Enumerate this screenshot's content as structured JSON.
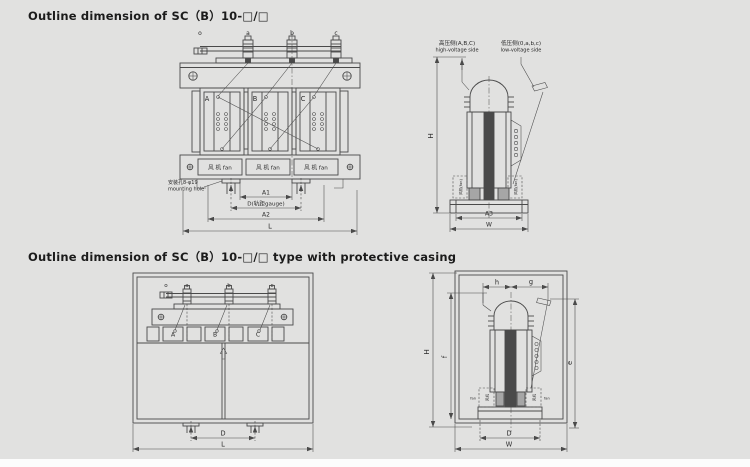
{
  "page": {
    "background": "#e1e1e0",
    "ink": "#4a4a4a"
  },
  "top_section": {
    "title": "Outline dimension of SC（B）10-□/□",
    "front": {
      "term_o": "o",
      "term_a": "a",
      "term_b": "b",
      "term_c": "c",
      "phase_a": "A",
      "phase_b": "B",
      "phase_c": "C",
      "fan": "风 机 fan",
      "mount_cn": "安装孔8-φ19",
      "mount_en": "mounting hole",
      "dim_a1": "A1",
      "dim_d": "D(轨距gauge)",
      "dim_a2": "A2",
      "dim_l": "L"
    },
    "side": {
      "hv_cn": "高压侧(A,B,C)",
      "hv_en": "high-voltage side",
      "lv_cn": "低压侧(0,a,b,c)",
      "lv_en": "low-voltage side",
      "fan_v": "风机(fan)",
      "dim_h": "H",
      "dim_a3": "A3",
      "dim_w": "W"
    }
  },
  "bottom_section": {
    "title": "Outline dimension of SC（B）10-□/□ type with protective casing",
    "front": {
      "term_o": "o",
      "term_a": "a",
      "term_b": "b",
      "term_c": "c",
      "phase_a": "A",
      "phase_b": "B",
      "phase_c": "C",
      "dim_d": "D",
      "dim_l": "L"
    },
    "side": {
      "dim_h": "h",
      "dim_g": "g",
      "dim_f": "f",
      "dim_e": "e",
      "dim_big_h": "H",
      "dim_d": "D",
      "dim_w": "W",
      "fan_cn": "风机",
      "fan_en": "fan"
    }
  }
}
